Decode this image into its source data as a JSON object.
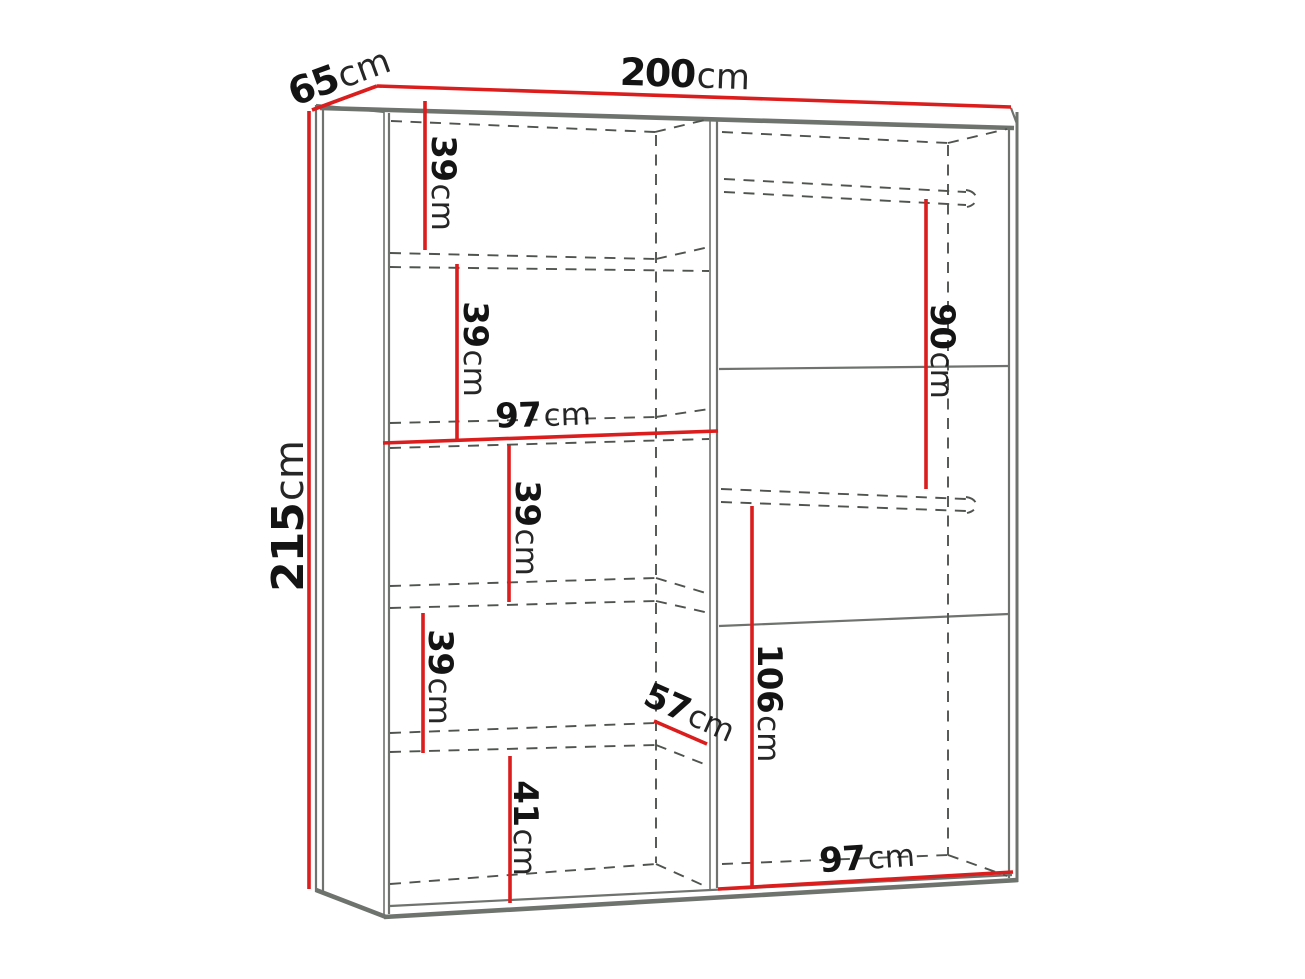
{
  "diagram": {
    "name": "wardrobe-dimension-diagram",
    "unit": "cm",
    "labels": {
      "width": {
        "value": "200",
        "unit": "cm"
      },
      "depth": {
        "value": "65",
        "unit": "cm"
      },
      "height": {
        "value": "215",
        "unit": "cm"
      },
      "left_shelf_1": {
        "value": "39",
        "unit": "cm"
      },
      "left_shelf_2": {
        "value": "39",
        "unit": "cm"
      },
      "left_section_width": {
        "value": "97",
        "unit": "cm"
      },
      "left_shelf_3": {
        "value": "39",
        "unit": "cm"
      },
      "left_shelf_4": {
        "value": "39",
        "unit": "cm"
      },
      "left_shelf_bottom": {
        "value": "41",
        "unit": "cm"
      },
      "right_rail_height": {
        "value": "90",
        "unit": "cm"
      },
      "interior_depth": {
        "value": "57",
        "unit": "cm"
      },
      "right_hanging_height": {
        "value": "106",
        "unit": "cm"
      },
      "right_section_width": {
        "value": "97",
        "unit": "cm"
      }
    }
  },
  "colors": {
    "dimension_red": "#db1d1d",
    "frame_gray": "#6e736e",
    "dash_gray": "#4f544f",
    "label_black": "#141414",
    "background": "#ffffff"
  }
}
